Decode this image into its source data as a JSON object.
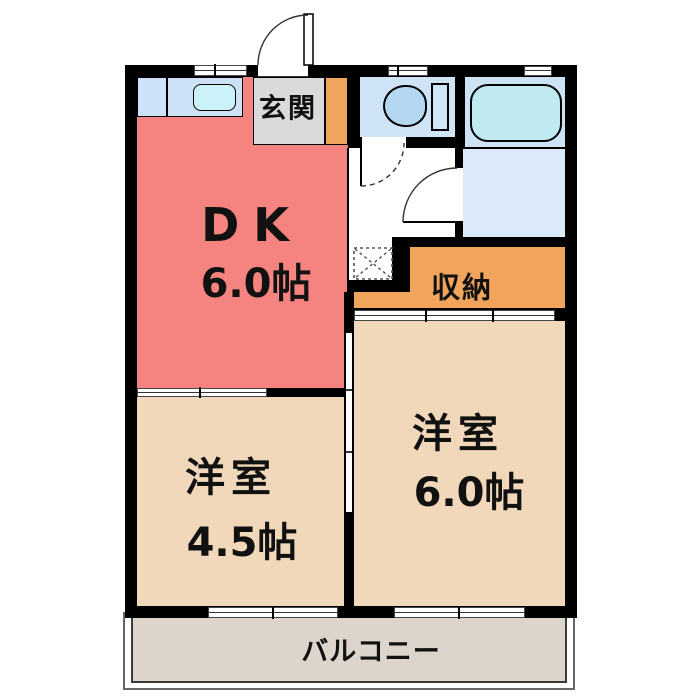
{
  "plan": {
    "type": "floor-plan",
    "rooms": {
      "dk": {
        "label": "DK",
        "size": "6.0帖"
      },
      "west1": {
        "label": "洋室",
        "size": "4.5帖"
      },
      "west2": {
        "label": "洋室",
        "size": "6.0帖"
      },
      "storage": {
        "label": "収納"
      },
      "entrance": {
        "label": "玄関"
      },
      "balcony": {
        "label": "バルコニー"
      }
    },
    "fixtures": [
      "kitchen-counter",
      "kitchen-sink",
      "toilet",
      "bathtub",
      "washing-machine-space"
    ],
    "colors": {
      "wall": "#000000",
      "dk_room": "#f5837f",
      "western_room": "#f2d8ba",
      "storage": "#f0a45c",
      "entrance_hall": "#dadada",
      "entrance_step": "#f0a45c",
      "toilet_room": "#cfe3f6",
      "bath_room": "#cce2f5",
      "washroom": "#dbeaf8",
      "bathtub": "#c0eaf2",
      "kitchen_counter": "#cde2f6",
      "kitchen_sink": "#cbf1f9",
      "balcony_deck": "#ddd5cb"
    }
  }
}
